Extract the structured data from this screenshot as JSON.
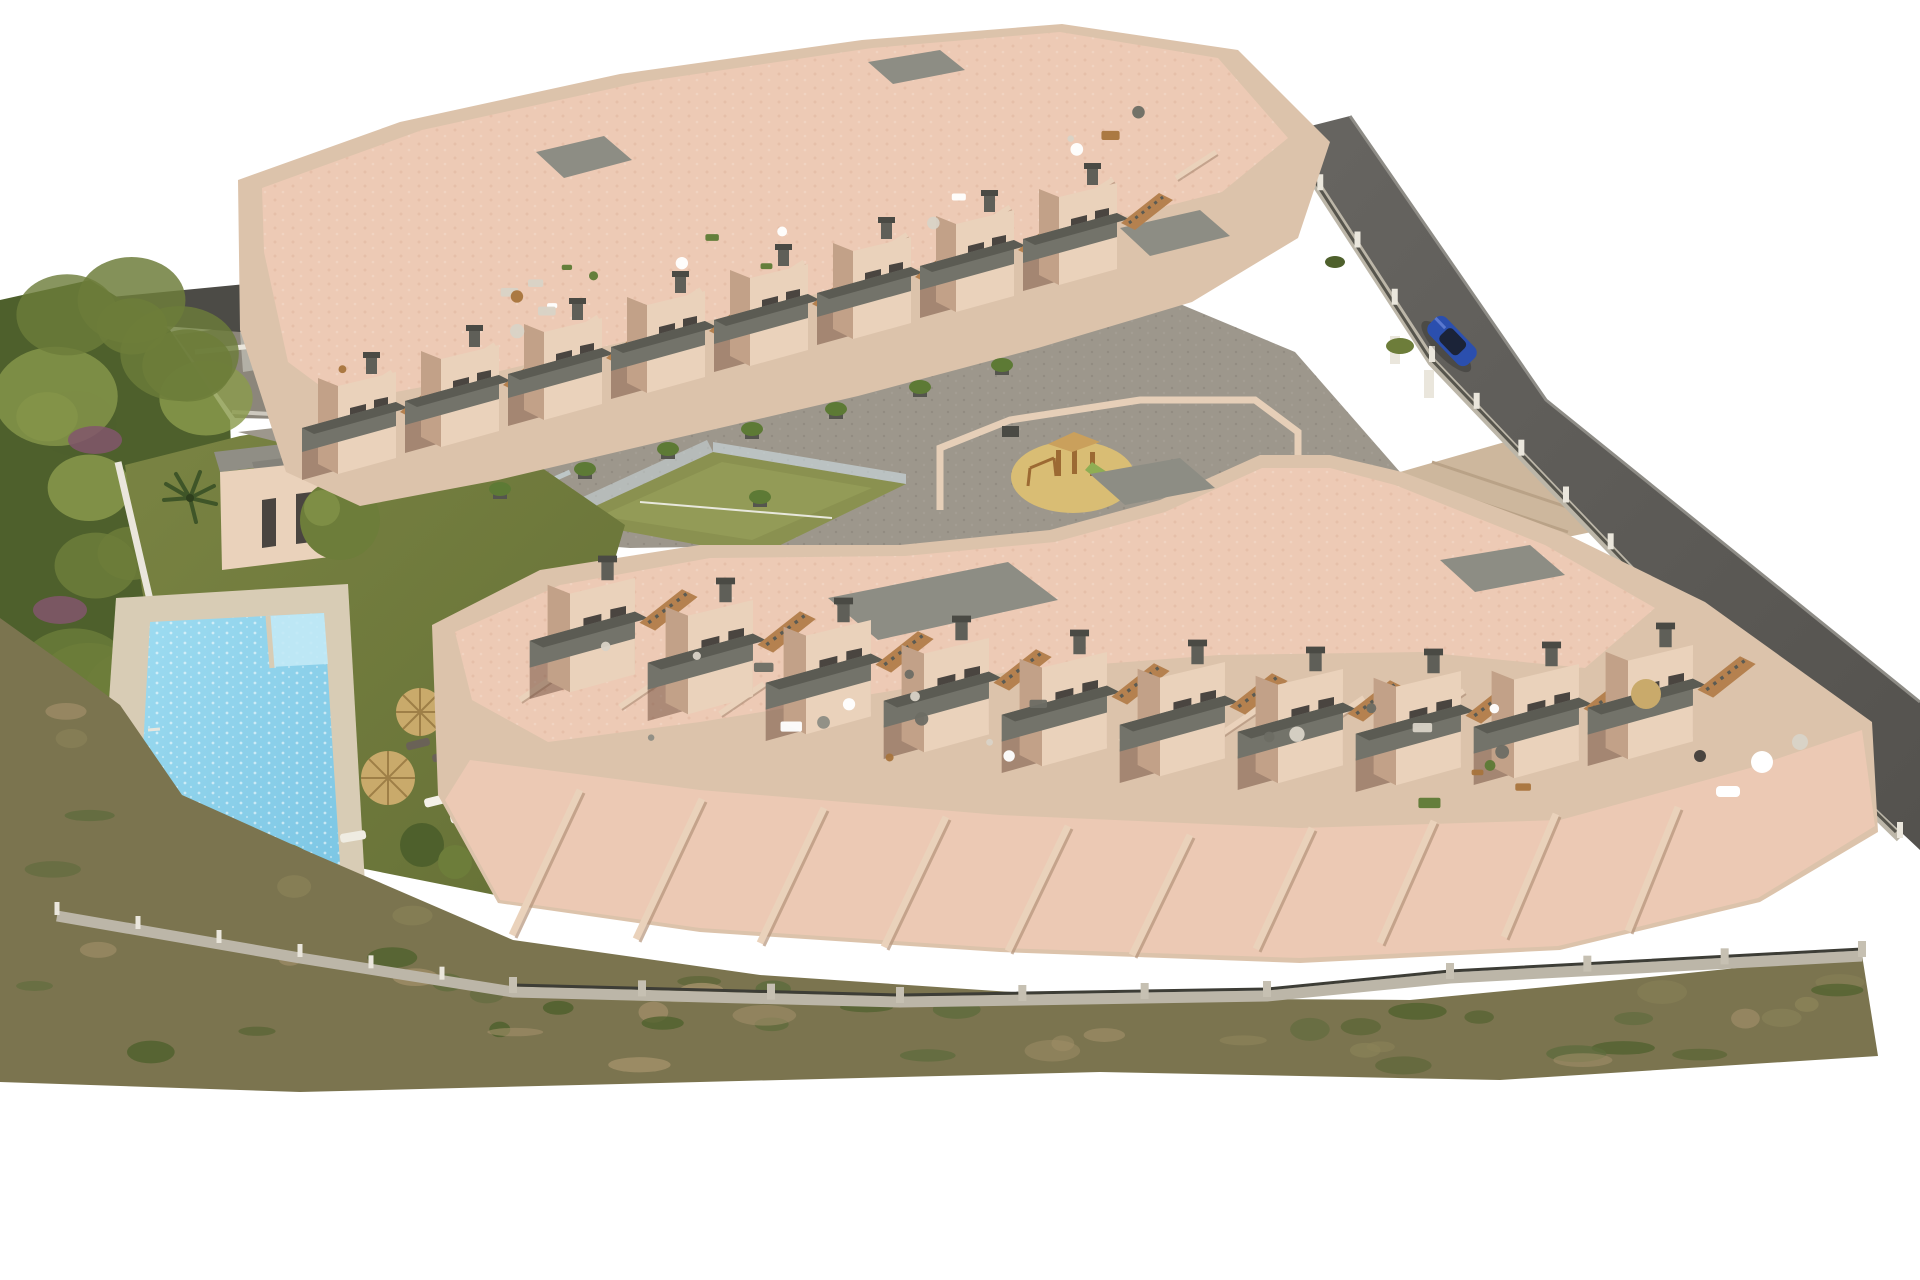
{
  "scene": {
    "kind": "aerial-3d-architectural-render",
    "description": "Top-down aerial render of a terraced apartment complex on a sloped wedge-shaped plot",
    "elements": [
      {
        "name": "north-apartment-block",
        "desc": "upper row of stepped apartments with pink rooftop terraces, gray balconies and outdoor stairs"
      },
      {
        "name": "south-apartment-block",
        "desc": "lower curved row of apartments with large pink roof terraces and fanned garden terraces"
      },
      {
        "name": "swimming-pool",
        "desc": "rectangular community pool with corner steps on a beige deck"
      },
      {
        "name": "kids-pool",
        "desc": "small secondary pool below the main pool"
      },
      {
        "name": "pool-house",
        "desc": "small flat-roofed amenity building beside the lawn"
      },
      {
        "name": "lawn",
        "desc": "green garden with straw parasols and sun loungers"
      },
      {
        "name": "padel-court",
        "desc": "green court with glass enclosure between the blocks"
      },
      {
        "name": "playground",
        "desc": "sand circle with wooden play structure inside the central plaza"
      },
      {
        "name": "central-plaza",
        "desc": "gray paved communal courtyard and walkways"
      },
      {
        "name": "access-road",
        "desc": "dark asphalt road along the north-east boundary"
      },
      {
        "name": "parked-car",
        "desc": "blue car driving on the access road"
      },
      {
        "name": "perimeter-wall",
        "desc": "stone retaining wall and white-post fence around the plot"
      },
      {
        "name": "scrubland",
        "desc": "dry brush strip along the south boundary"
      },
      {
        "name": "tree-band",
        "desc": "dense green trees with purple flowering shrubs on the west side"
      },
      {
        "name": "neighbor-building",
        "desc": "existing building with dark roof beyond the north-west corner"
      }
    ]
  },
  "colors": {
    "bg": "#ffffff",
    "wall_light": "#ead2bb",
    "wall_mid": "#dcc3ab",
    "wall_shade": "#c2a188",
    "wall_dark": "#a98a73",
    "roof_terrace": "#edcab5",
    "roof_terrace_dark": "#dfb29b",
    "flat_roof": "#8d8d84",
    "balcony": "#73736a",
    "balcony_dark": "#5b5b53",
    "shadow_brown": "#6b4a39",
    "window": "#4a4540",
    "stair_wood": "#b5814f",
    "chimney": "#5f5f58",
    "plaza": "#9d978c",
    "plaza_dark": "#8c867b",
    "ramp": "#cdb79d",
    "road": "#5f5d59",
    "road_light": "#8e8c86",
    "stone_wall": "#bcb6a8",
    "fence_dark": "#3d3d36",
    "white_wall": "#eae6dc",
    "lawn": "#75803f",
    "lawn_dark": "#66713a",
    "tree_green": "#6d7d3a",
    "tree_dark": "#4e602c",
    "tree_light": "#8a9a4c",
    "shrub_purple": "#82566c",
    "palm_green": "#3f5528",
    "scrub_base": "#7b744f",
    "scrub_green": "#5d6b3c",
    "scrub_tan": "#a3906a",
    "pool_water": "#8fd3ec",
    "pool_light": "#c2e9f6",
    "pool_deck": "#d8ccb5",
    "sand": "#d9bd74",
    "play_wood": "#9c6a33",
    "play_roof": "#caa05c",
    "slide_green": "#8fae54",
    "car_blue": "#2b4fae",
    "car_glass": "#1b2338",
    "umbrella": "#c9aa6b",
    "umbrella_rib": "#9e7f47",
    "glass": "#cfe0e6",
    "court_green": "#8a9150",
    "court_light": "#97a05a",
    "neighbor_roof": "#4c4b46",
    "neighbor_wall": "#b3b0a6",
    "furniture_white": "#ffffff",
    "furniture_gray": "#d9d3c7",
    "plant_green": "#5d7a35"
  },
  "generate": {
    "north_units": 8,
    "south_units": 10,
    "north_partitions": 9,
    "south_partitions": 12,
    "tree_blobs": 20,
    "scrub_patches": 52,
    "roof_furniture_north": 20,
    "roof_furniture_south": 24
  }
}
